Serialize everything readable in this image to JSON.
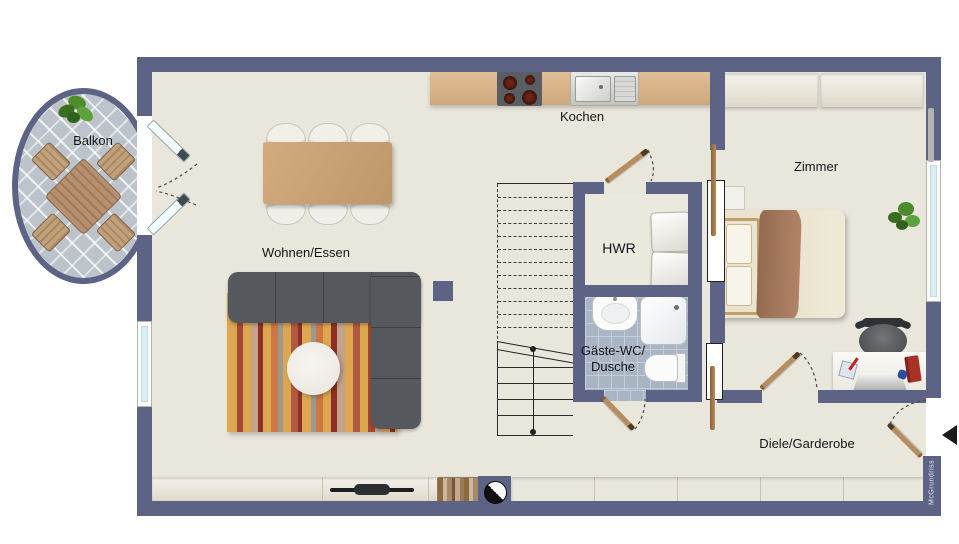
{
  "plan": {
    "rooms": [
      {
        "id": "balkon",
        "name": "Balkon"
      },
      {
        "id": "kochen",
        "name": "Kochen"
      },
      {
        "id": "zimmer",
        "name": "Zimmer"
      },
      {
        "id": "wohnen-essen",
        "name": "Wohnen/Essen"
      },
      {
        "id": "hwr",
        "name": "HWR"
      },
      {
        "id": "gaeste-wc",
        "name": "Gäste-WC/",
        "name2": "Dusche"
      },
      {
        "id": "diele",
        "name": "Diele/Garderobe"
      }
    ],
    "watermark": "McGrundriss",
    "colors": {
      "wall": "#5c6384",
      "floor": "#e9e6db",
      "counter": "#d7b48c",
      "tile": "#a9b5c3",
      "sofa": "#55585c",
      "rug": "#dca74f",
      "wood": "#a97f52",
      "glass": "#d8eef0",
      "balcony": "#bcc3ca"
    }
  }
}
